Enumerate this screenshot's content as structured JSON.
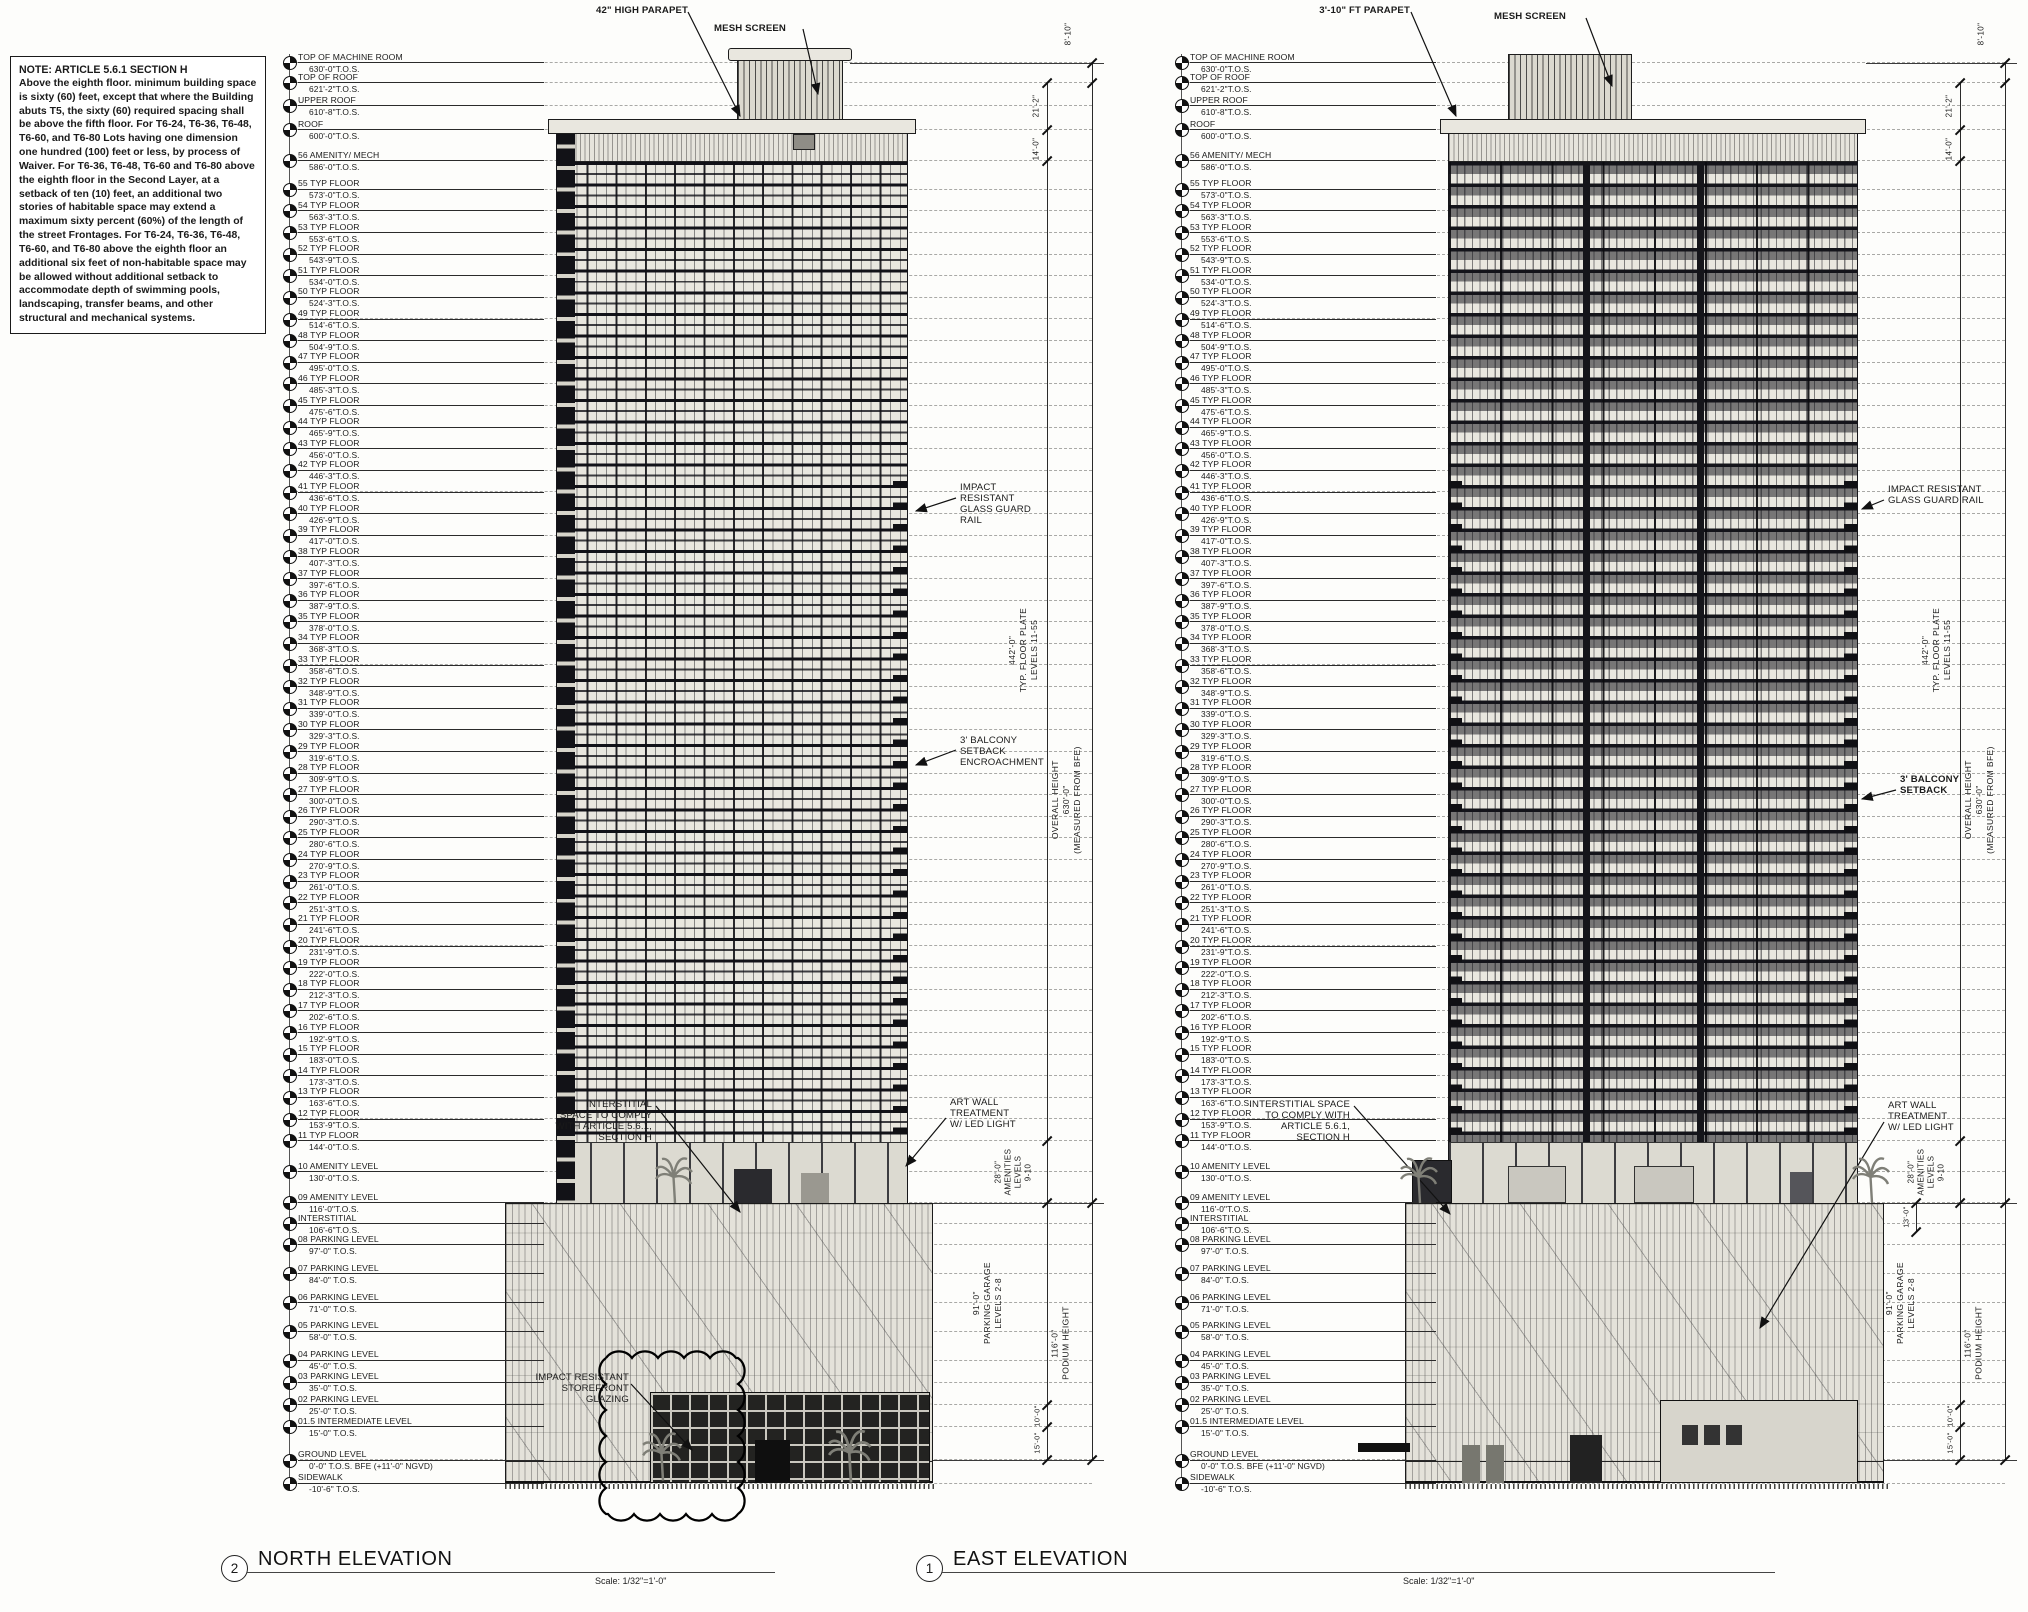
{
  "note": {
    "title": "NOTE: ARTICLE 5.6.1 SECTION H",
    "body": "Above the eighth floor. minimum building space is sixty (60) feet, except that where the Building abuts T5, the sixty (60) required spacing shall be above the fifth floor. For T6-24, T6-36, T6-48, T6-60, and T6-80 Lots having one dimension one hundred (100) feet or less, by process of Waiver. For T6-36, T6-48, T6-60 and T6-80 above the eighth floor in the Second Layer, at a setback of ten (10) feet, an additional two stories of habitable space may extend a maximum sixty percent (60%) of the length of the street Frontages. For T6-24, T6-36, T6-48, T6-60, and T6-80 above the eighth floor an additional six feet of non-habitable space may be allowed without additional setback to accommodate depth of swimming pools, landscaping, transfer beams, and other structural and mechanical systems."
  },
  "levels": [
    {
      "name": "TOP OF MACHINE ROOM",
      "value": "630'-0\"T.O.S.",
      "ft": 630
    },
    {
      "name": "TOP OF ROOF",
      "value": "621'-2\"T.O.S.",
      "ft": 621.17
    },
    {
      "name": "UPPER ROOF",
      "value": "610'-8\"T.O.S.",
      "ft": 610.67
    },
    {
      "name": "ROOF",
      "value": "600'-0\"T.O.S.",
      "ft": 600
    },
    {
      "name": "56 AMENITY/ MECH",
      "value": "586'-0\"T.O.S.",
      "ft": 586
    },
    {
      "name": "55 TYP FLOOR",
      "value": "573'-0\"T.O.S.",
      "ft": 573
    },
    {
      "name": "54 TYP FLOOR",
      "value": "563'-3\"T.O.S.",
      "ft": 563.25
    },
    {
      "name": "53 TYP FLOOR",
      "value": "553'-6\"T.O.S.",
      "ft": 553.5
    },
    {
      "name": "52 TYP FLOOR",
      "value": "543'-9\"T.O.S.",
      "ft": 543.75
    },
    {
      "name": "51 TYP FLOOR",
      "value": "534'-0\"T.O.S.",
      "ft": 534
    },
    {
      "name": "50 TYP FLOOR",
      "value": "524'-3\"T.O.S.",
      "ft": 524.25
    },
    {
      "name": "49 TYP FLOOR",
      "value": "514'-6\"T.O.S.",
      "ft": 514.5
    },
    {
      "name": "48 TYP FLOOR",
      "value": "504'-9\"T.O.S.",
      "ft": 504.75
    },
    {
      "name": "47 TYP FLOOR",
      "value": "495'-0\"T.O.S.",
      "ft": 495
    },
    {
      "name": "46 TYP FLOOR",
      "value": "485'-3\"T.O.S.",
      "ft": 485.25
    },
    {
      "name": "45 TYP FLOOR",
      "value": "475'-6\"T.O.S.",
      "ft": 475.5
    },
    {
      "name": "44 TYP FLOOR",
      "value": "465'-9\"T.O.S.",
      "ft": 465.75
    },
    {
      "name": "43 TYP FLOOR",
      "value": "456'-0\"T.O.S.",
      "ft": 456
    },
    {
      "name": "42 TYP FLOOR",
      "value": "446'-3\"T.O.S.",
      "ft": 446.25
    },
    {
      "name": "41 TYP FLOOR",
      "value": "436'-6\"T.O.S.",
      "ft": 436.5
    },
    {
      "name": "40 TYP FLOOR",
      "value": "426'-9\"T.O.S.",
      "ft": 426.75
    },
    {
      "name": "39 TYP FLOOR",
      "value": "417'-0\"T.O.S.",
      "ft": 417
    },
    {
      "name": "38 TYP FLOOR",
      "value": "407'-3\"T.O.S.",
      "ft": 407.25
    },
    {
      "name": "37 TYP FLOOR",
      "value": "397'-6\"T.O.S.",
      "ft": 397.5
    },
    {
      "name": "36 TYP FLOOR",
      "value": "387'-9\"T.O.S.",
      "ft": 387.75
    },
    {
      "name": "35 TYP FLOOR",
      "value": "378'-0\"T.O.S.",
      "ft": 378
    },
    {
      "name": "34 TYP FLOOR",
      "value": "368'-3\"T.O.S.",
      "ft": 368.25
    },
    {
      "name": "33 TYP FLOOR",
      "value": "358'-6\"T.O.S.",
      "ft": 358.5
    },
    {
      "name": "32 TYP FLOOR",
      "value": "348'-9\"T.O.S.",
      "ft": 348.75
    },
    {
      "name": "31 TYP FLOOR",
      "value": "339'-0\"T.O.S.",
      "ft": 339
    },
    {
      "name": "30 TYP FLOOR",
      "value": "329'-3\"T.O.S.",
      "ft": 329.25
    },
    {
      "name": "29 TYP FLOOR",
      "value": "319'-6\"T.O.S.",
      "ft": 319.5
    },
    {
      "name": "28 TYP FLOOR",
      "value": "309'-9\"T.O.S.",
      "ft": 309.75
    },
    {
      "name": "27 TYP FLOOR",
      "value": "300'-0\"T.O.S.",
      "ft": 300
    },
    {
      "name": "26 TYP FLOOR",
      "value": "290'-3\"T.O.S.",
      "ft": 290.25
    },
    {
      "name": "25 TYP FLOOR",
      "value": "280'-6\"T.O.S.",
      "ft": 280.5
    },
    {
      "name": "24 TYP FLOOR",
      "value": "270'-9\"T.O.S.",
      "ft": 270.75
    },
    {
      "name": "23 TYP FLOOR",
      "value": "261'-0\"T.O.S.",
      "ft": 261
    },
    {
      "name": "22 TYP FLOOR",
      "value": "251'-3\"T.O.S.",
      "ft": 251.25
    },
    {
      "name": "21 TYP FLOOR",
      "value": "241'-6\"T.O.S.",
      "ft": 241.5
    },
    {
      "name": "20 TYP FLOOR",
      "value": "231'-9\"T.O.S.",
      "ft": 231.75
    },
    {
      "name": "19 TYP FLOOR",
      "value": "222'-0\"T.O.S.",
      "ft": 222
    },
    {
      "name": "18 TYP FLOOR",
      "value": "212'-3\"T.O.S.",
      "ft": 212.25
    },
    {
      "name": "17 TYP FLOOR",
      "value": "202'-6\"T.O.S.",
      "ft": 202.5
    },
    {
      "name": "16 TYP FLOOR",
      "value": "192'-9\"T.O.S.",
      "ft": 192.75
    },
    {
      "name": "15 TYP FLOOR",
      "value": "183'-0\"T.O.S.",
      "ft": 183
    },
    {
      "name": "14 TYP FLOOR",
      "value": "173'-3\"T.O.S.",
      "ft": 173.25
    },
    {
      "name": "13 TYP FLOOR",
      "value": "163'-6\"T.O.S.",
      "ft": 163.5
    },
    {
      "name": "12 TYP FLOOR",
      "value": "153'-9\"T.O.S.",
      "ft": 153.75
    },
    {
      "name": "11 TYP FLOOR",
      "value": "144'-0\"T.O.S.",
      "ft": 144
    },
    {
      "name": "10 AMENITY LEVEL",
      "value": "130'-0\"T.O.S.",
      "ft": 130
    },
    {
      "name": "09 AMENITY LEVEL",
      "value": "116'-0\"T.O.S.",
      "ft": 116
    },
    {
      "name": "INTERSTITIAL",
      "value": "106'-6\"T.O.S.",
      "ft": 106.5
    },
    {
      "name": "08 PARKING LEVEL",
      "value": "97'-0\"  T.O.S.",
      "ft": 97
    },
    {
      "name": "07 PARKING LEVEL",
      "value": "84'-0\"  T.O.S.",
      "ft": 84
    },
    {
      "name": "06 PARKING LEVEL",
      "value": "71'-0\"  T.O.S.",
      "ft": 71
    },
    {
      "name": "05 PARKING LEVEL",
      "value": "58'-0\"  T.O.S.",
      "ft": 58
    },
    {
      "name": "04 PARKING LEVEL",
      "value": "45'-0\"  T.O.S.",
      "ft": 45
    },
    {
      "name": "03 PARKING LEVEL",
      "value": "35'-0\"  T.O.S.",
      "ft": 35
    },
    {
      "name": "02 PARKING LEVEL",
      "value": "25'-0\"  T.O.S.",
      "ft": 25
    },
    {
      "name": "01.5 INTERMEDIATE LEVEL",
      "value": "15'-0\"  T.O.S.",
      "ft": 15
    },
    {
      "name": "GROUND LEVEL",
      "value": "0'-0\"   T.O.S.  BFE (+11'-0\" NGVD)",
      "ft": 0
    },
    {
      "name": "SIDEWALK",
      "value": "-10'-6\" T.O.S.",
      "ft": -10.5
    }
  ],
  "annotations": {
    "north": {
      "parapet": [
        "42\" HIGH PARAPET"
      ],
      "mesh": [
        "MESH SCREEN"
      ],
      "guard": [
        "IMPACT",
        "RESISTANT",
        "GLASS GUARD",
        "RAIL"
      ],
      "balcony": [
        "3' BALCONY",
        "SETBACK",
        "ENCROACHMENT"
      ],
      "art": [
        "ART WALL",
        "TREATMENT",
        "W/ LED LIGHT"
      ],
      "interstitial": [
        "INTERSTITIAL",
        "SPACE TO  COMPLY",
        "WITH  ARTICLE 5.6.1,",
        "SECTION H"
      ],
      "storefront": [
        "IMPACT RESISTANT",
        "STOREFRONT",
        "GLAZING"
      ]
    },
    "east": {
      "parapet": [
        "3'-10\" FT PARAPET"
      ],
      "mesh": [
        "MESH SCREEN"
      ],
      "guard": [
        "IMPACT RESISTANT",
        "GLASS GUARD RAIL"
      ],
      "balcony": [
        "3' BALCONY",
        "SETBACK"
      ],
      "art": [
        "ART WALL",
        "TREATMENT",
        "W/ LED LIGHT"
      ],
      "interstitial": [
        "INTERSTITIAL SPACE",
        "TO COMPLY WITH",
        "ARTICLE 5.6.1,",
        "SECTION H"
      ]
    }
  },
  "dimensions": {
    "d8_10": "8'-10\"",
    "d21_2": "21'-2\"",
    "d14_0": "14'-0\"",
    "floor_plate": [
      "442'-0\"",
      "TYP. FLOOR PLATE",
      "LEVELS 11-55"
    ],
    "overall": [
      "OVERALL HEIGHT",
      "630'-0\"",
      "(MEASURED FROM BFE)"
    ],
    "amenities": [
      "28'-0\"",
      "AMENITIES",
      "LEVELS",
      "9-10"
    ],
    "parking": [
      "91'-0\"",
      "PARKING GARAGE",
      "LEVELS 2-8"
    ],
    "podium": [
      "116'-0\"",
      "PODIUM HEIGHT"
    ],
    "d10_0": "10'-0\"",
    "d15_0": "15'-0\"",
    "d13_0": "13'-0\""
  },
  "titles": {
    "north": {
      "number": "2",
      "label": "NORTH ELEVATION",
      "scale": "Scale:  1/32\"=1'-0\""
    },
    "east": {
      "number": "1",
      "label": "EAST ELEVATION",
      "scale": "Scale:  1/32\"=1'-0\""
    }
  }
}
